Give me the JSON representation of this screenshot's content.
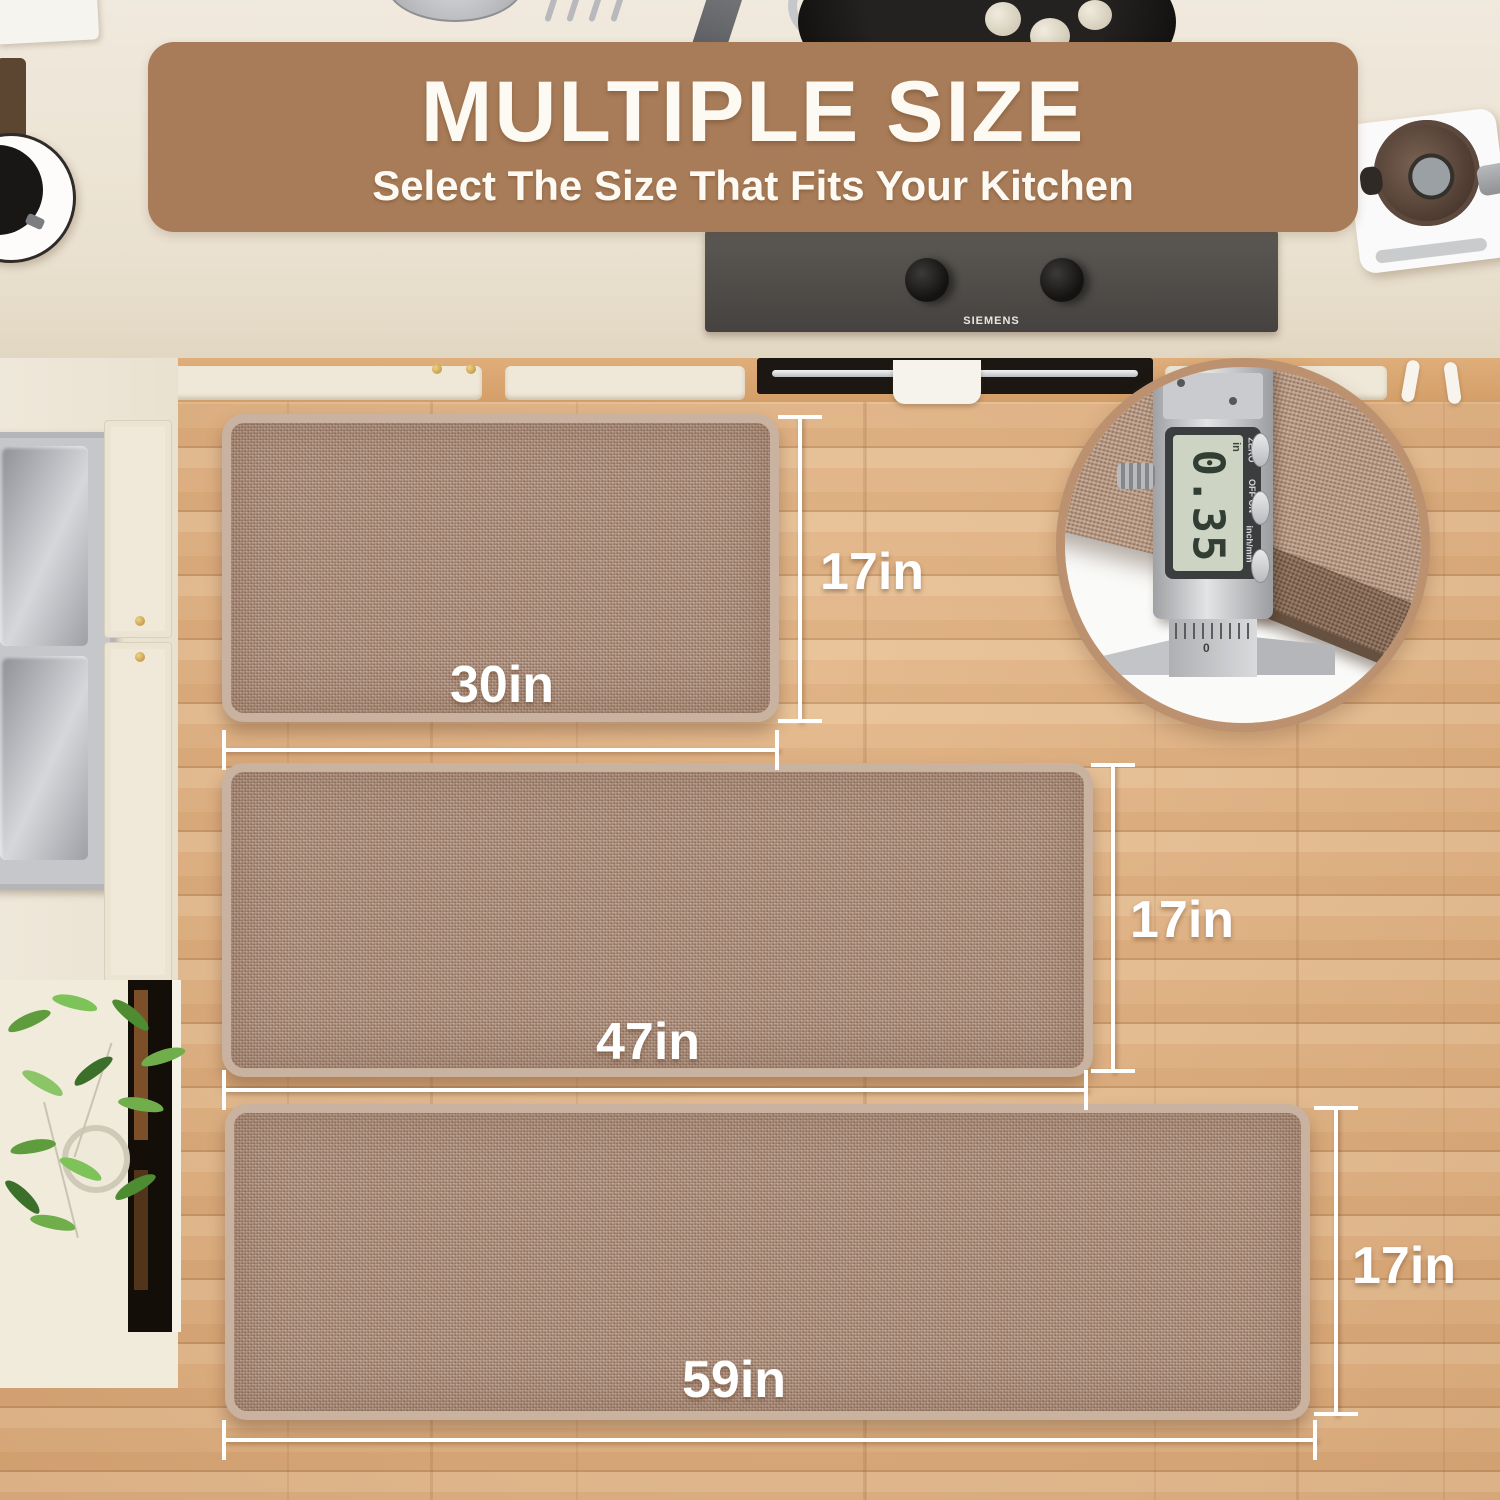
{
  "banner": {
    "title": "MULTIPLE SIZE",
    "subtitle": "Select The Size That Fits Your Kitchen"
  },
  "mats": [
    {
      "name": "small-mat",
      "length_label": "30in",
      "width_label": "17in"
    },
    {
      "name": "runner-mat",
      "length_label": "47in",
      "width_label": "17in"
    },
    {
      "name": "long-runner-mat",
      "length_label": "59in",
      "width_label": "17in"
    }
  ],
  "cooktop": {
    "brand": "SIEMENS"
  },
  "inset": {
    "display_value": "0.35",
    "display_unit": "in",
    "label_zero": "ZERO",
    "label_onoff": "OFF ON",
    "label_inchmm": "inch/mm",
    "scale_zero": "0"
  },
  "colors": {
    "banner_bg": "#a87c58",
    "banner_text": "#fdfaf4",
    "floor": "#e0b284",
    "mat_base": "#b3947f",
    "mat_border": "#c9b2a0",
    "counter": "#ece4d6",
    "inset_ring": "#bb9170",
    "dimension": "#ffffff"
  }
}
